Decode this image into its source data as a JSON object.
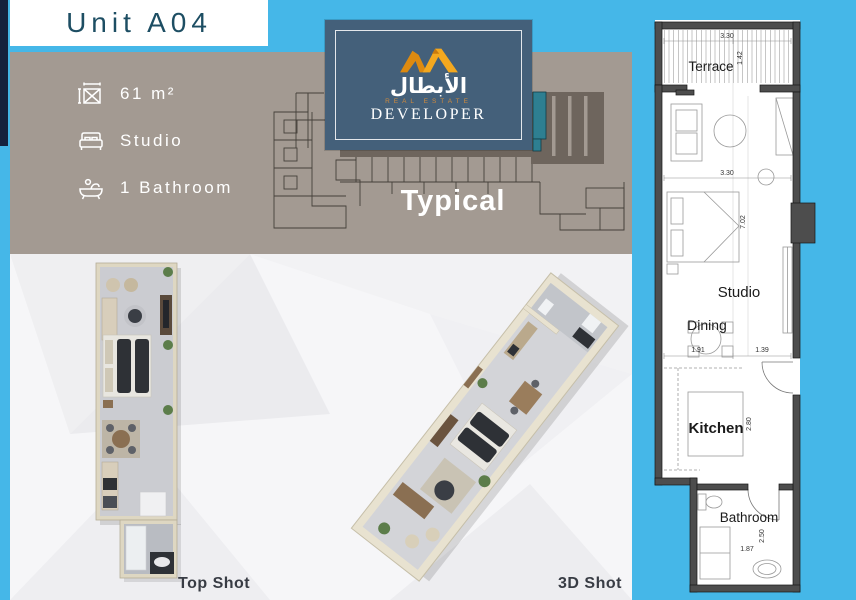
{
  "header": {
    "title": "Unit A04"
  },
  "info_panel": {
    "items": [
      {
        "icon": "area-icon",
        "label": "61 m²"
      },
      {
        "icon": "bed-icon",
        "label": "Studio"
      },
      {
        "icon": "bath-icon",
        "label": "1 Bathroom"
      }
    ]
  },
  "logo": {
    "arabic": "الأبطال",
    "tagline": "REAL ESTATE",
    "name": "DEVELOPER"
  },
  "key_plan": {
    "caption": "Typical",
    "highlight_color": "#2e7f91"
  },
  "renders": {
    "top_label": "Top Shot",
    "threed_label": "3D Shot"
  },
  "floorplan": {
    "terrace": {
      "label": "Terrace",
      "width": "3.30",
      "depth": "1.42"
    },
    "studio": {
      "label": "Studio",
      "width": "3.30",
      "depth": "7.02"
    },
    "dining": {
      "label": "Dining",
      "left": "1.91",
      "right": "1.39"
    },
    "kitchen": {
      "label": "Kitchen",
      "depth": "2.80"
    },
    "bathroom": {
      "label": "Bathroom",
      "width": "1.87",
      "depth": "2.50"
    }
  },
  "colors": {
    "background": "#45b7e8",
    "panel": "#a39a92",
    "navy": "#15223e",
    "accent_orange": "#f0a01c",
    "highlight_teal": "#2e7f91",
    "wall": "#4d4d4d"
  }
}
